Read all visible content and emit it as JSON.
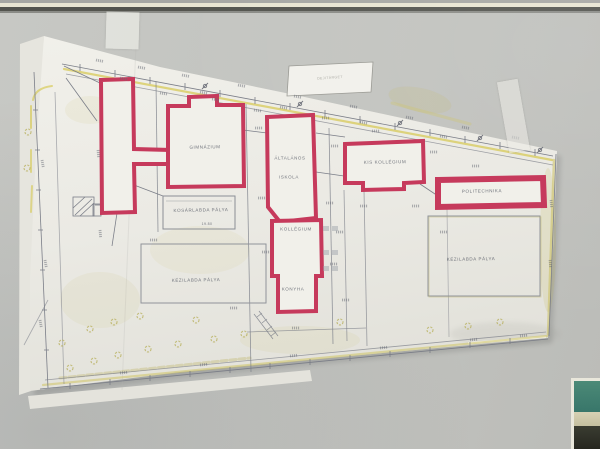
{
  "plan": {
    "labels": {
      "gimnazium": "GIMNÁZIUM",
      "altalanos": "ÁLTALÁNOS",
      "iskola": "ISKOLA",
      "kis_kollegium": "KIS KOLLÉGIUM",
      "politechnika": "POLITECHNIKA",
      "kollegium": "KOLLÉGIUM",
      "konyha": "KONYHA",
      "kosarlabda_palya": "KOSÁRLABDA PÁLYA",
      "kezilabda_palya_left": "KÉZILABDA PÁLYA",
      "kezilabda_palya_right": "KÉZILABDA PÁLYA",
      "title_box": "DEJITÁRGET",
      "dim_19_80": "19.80"
    },
    "colors": {
      "building_outline_red": "#c63a5c",
      "paper": "#edece6",
      "wall": "#c3c4c0",
      "pencil": "#7b7e88",
      "highlight_yellow": "#d5c84e",
      "photo_teal": "#41806f"
    }
  }
}
